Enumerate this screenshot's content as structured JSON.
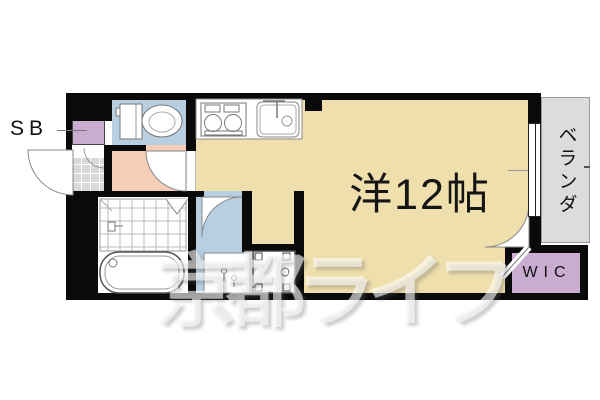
{
  "plan": {
    "labels": {
      "shoe_box": "SB",
      "main_room": "洋12帖",
      "veranda": "ベランダ",
      "walk_in_closet": "WIC"
    },
    "watermark": "京都ライフ",
    "colors": {
      "floor-main": "#efdfac",
      "floor-wet": "#b8cfe2",
      "floor-hall": "#f6cdb6",
      "floor-closet": "#c9add1",
      "floor-veranda": "#dcdcdc",
      "tile": "#d9d9d9",
      "wall": "#0a0a0a"
    }
  }
}
